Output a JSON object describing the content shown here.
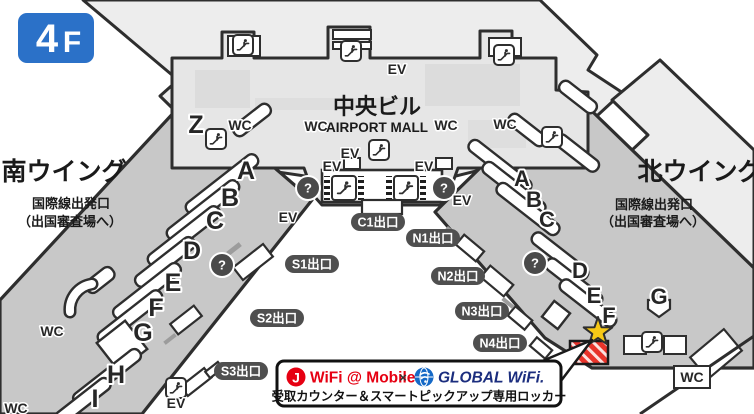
{
  "floor_badge": {
    "number": "4",
    "suffix": "F"
  },
  "labels": {
    "central_building": "中央ビル",
    "airport_mall": "AIRPORT MALL",
    "south_wing": "南ウイング",
    "north_wing": "北ウイング",
    "intl_departure": "国際線出発口",
    "immigration": "（出国審査場へ）",
    "wc": "WC",
    "ev": "EV",
    "question": "?"
  },
  "exits": {
    "c1": "C1出口",
    "n1": "N1出口",
    "n2": "N2出口",
    "n3": "N3出口",
    "n4": "N4出口",
    "s1": "S1出口",
    "s2": "S2出口",
    "s3": "S3出口"
  },
  "counters": {
    "south": [
      "Z",
      "A",
      "B",
      "C",
      "D",
      "E",
      "F",
      "G",
      "H",
      "I"
    ],
    "north": [
      "A",
      "B",
      "C",
      "D",
      "E",
      "F",
      "G"
    ]
  },
  "banner": {
    "j_logo": "J",
    "wifi_mobile": "WiFi @ Mobile",
    "cross": "×",
    "global_wifi": "GLOBAL WiFi.",
    "description": "受取カウンター＆スマートピックアップ専用ロッカー"
  },
  "colors": {
    "floor_badge_blue": "#2b71c8",
    "wing_gray": "#c8c8c8",
    "central_gray": "#e6e6e6",
    "backdrop_gray": "#ededed",
    "outline": "#2e2e2e",
    "exit_pill": "#4f4f4f",
    "marker_red": "#e8332a",
    "star_yellow": "#f6c816",
    "jwifi_red": "#e60012",
    "globalwifi_blue": "#1b2d7e",
    "globe_blue": "#1569c7"
  }
}
